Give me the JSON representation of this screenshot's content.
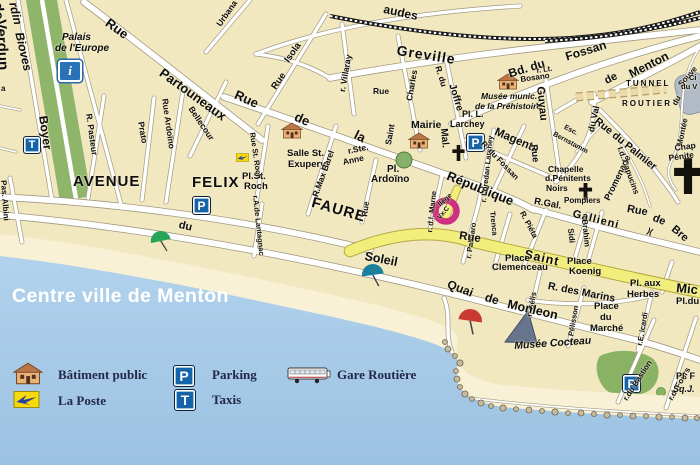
{
  "title": "Centre ville de Menton",
  "legend": {
    "batiment_public": "Bâtiment public",
    "la_poste": "La Poste",
    "parking": "Parking",
    "taxis": "Taxis",
    "gare_routiere": "Gare Routière"
  },
  "icons": {
    "parking_letter": "P",
    "taxi_letter": "T",
    "info_letter": "i",
    "stairs_symbol": ")("
  },
  "marker": {
    "label": "Vx.C",
    "color": "#cf2f80"
  },
  "colors": {
    "sea": "#a7c9e6",
    "beach": "#f8f1d6",
    "land": "#f2e8c0",
    "park_green": "#8fb56b",
    "pedestrian_street_yellow": "#f2ee7b",
    "icon_blue": "#1563a8",
    "poste_yellow": "#f7d908",
    "marker_pink": "#cf2f80"
  },
  "labels": {
    "jardin1": "rdin",
    "jardin2": "Bioves",
    "verdun1": "de",
    "verdun2": "Verdun",
    "palais1": "Palais",
    "palais2": "de l'Europe",
    "boyer": "Boyer",
    "albini": "Pas. Albini",
    "frag_a": "a",
    "avenue": "AVENUE",
    "felix": "FELIX",
    "faure": "FAURE",
    "plstroch1": "Pl.St.",
    "plstroch2": "Roch",
    "ruestroch": "Rue St. Roch",
    "lantagnac": "r.A.de Lantagnac",
    "pasteur": "R. Pasteur",
    "prato": "Prato",
    "ardoino": "Rue Ardoïno",
    "bellecour": "Bellecour",
    "partouneaux1": "Rue",
    "partouneaux2": "Partouneaux",
    "urbana": "Urbana",
    "isola1": "Isola",
    "isola2": "Rue",
    "villaray": "r. Villaray",
    "audes": "audes",
    "greville": "Greville",
    "stcharles_rue": "Rue",
    "stcharles_saint": "Saint",
    "stcharles_charles": "Charles",
    "ruedela1": "Rue",
    "ruedela2": "de",
    "ruedela3": "la",
    "republique": "République",
    "salle1": "Salle St.",
    "salle2": "Exupery",
    "maxbarel": "R.Max Barel",
    "steanne1": "r.Ste.",
    "steanne2": "Anne",
    "plardoino1": "Pl.",
    "plardoino2": "Ardoïno",
    "ruemid": "Rue",
    "mairie": "Mairie",
    "larchey1": "Pl. L.",
    "larchey2": "Larchey",
    "prehist1": "Musée munic.",
    "prehist2": "de la Préhistoire",
    "joffre1": "R. du",
    "joffre2": "Joffre",
    "bdfossan1": "Bd. du",
    "bdfossan2": "Fossan",
    "bosano1": "r. Lt.",
    "bosano2": "Bosano",
    "menton1": "de",
    "menton2": "Menton",
    "tunnel1": "TUNNEL",
    "tunnel2": "ROUTIER",
    "montee": "Montée",
    "montee_du": "du",
    "souve": "Souve",
    "cim1": "Ci",
    "cim2": "du V",
    "mal": "Mal.",
    "magenta": "Magenta",
    "loredan": "r. Loredan Larchey",
    "rdufossan": "R. du Fossan",
    "guyau1": "Guyau",
    "guyau2": "Rue",
    "esc1": "Esc.",
    "esc2": "Bernstamm",
    "promenade": "Promenade",
    "duval": "du Val",
    "palmier": "Rue du Palmier",
    "capucins": "I.d. Capucins",
    "chapnoirs1": "Chapelle",
    "chapnoirs2": "d.Pénitents",
    "chapnoirs3": "Noirs",
    "pompiers": "Pompiers",
    "rgal": "R.Gal.",
    "gallieni": "Gallieni",
    "brea1": "Rue",
    "brea2": "de",
    "brea3": "Bre",
    "chapright1": "Chap",
    "chapright2": "Pénite",
    "marne": "r. d.l. Marne",
    "college": "llège",
    "palmaro": "r. Palmaro",
    "trenca": "Trenca",
    "pieta": "R. Piéta",
    "sidi": "Sidi",
    "brahim": "Brahim",
    "rueyellow": "Rue",
    "saintyellow": "Saint",
    "mic": "Mic",
    "pldu": "Pl.du",
    "clemenceau1": "Place",
    "clemenceau2": "Clemenceau",
    "koenig1": "Place",
    "koenig2": "Koenig",
    "herbes1": "Pl. aux",
    "herbes2": "Herbes",
    "marins": "R. des Marins",
    "gelis": "r. Gélis",
    "pelisson": "r. Pélisson",
    "marche1": "Place",
    "marche2": "du",
    "marche3": "Marché",
    "icardi": "r.E. icardi",
    "bastion": "r.du Bastion",
    "fours": "r.d. Fours",
    "plf": "Pl. F",
    "sqj": "Sq.J.",
    "cocteau": "Musée Cocteau",
    "quai1": "Quai",
    "quai2": "de",
    "quai3": "Monleon",
    "soleil": "Soleil",
    "dushore": "du"
  }
}
